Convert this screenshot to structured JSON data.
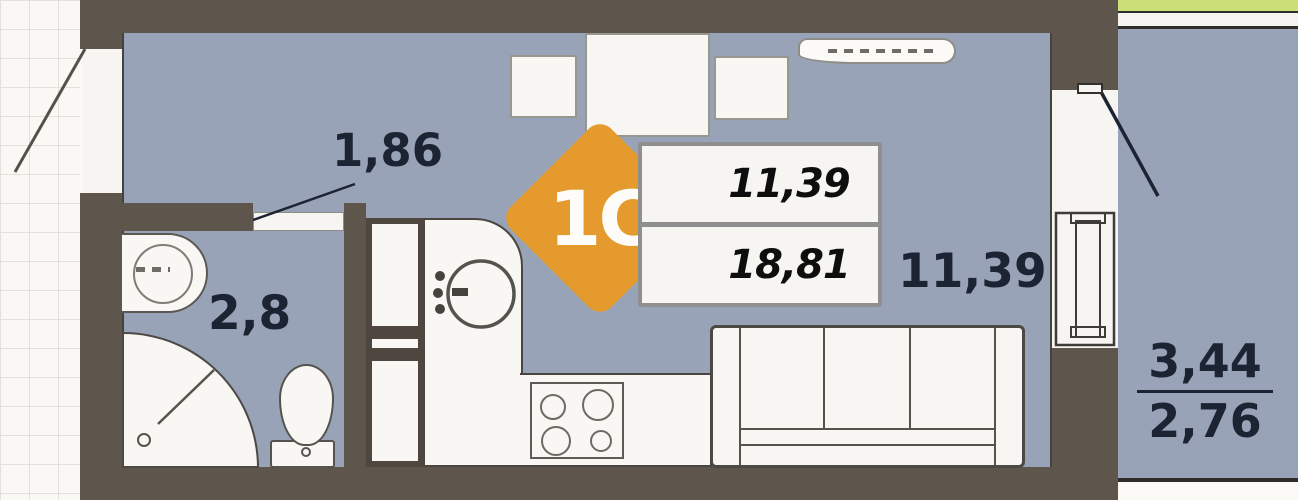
{
  "title": "Studio apartment floor plan",
  "badge": {
    "label": "1C"
  },
  "area_box": {
    "living_area": "11,39",
    "total_area": "18,81"
  },
  "room_labels": {
    "hallway_area": "1,86",
    "bathroom_area": "2,8",
    "main_room_area": "11,39",
    "balcony_area_full": "3,44",
    "balcony_area_reduced": "2,76"
  },
  "colors": {
    "floor": "#99a3b7",
    "wall": "#5e554c",
    "badge": "#e49a2d",
    "green": "#ccde77",
    "label": "#1c2333",
    "outline": "#4a463f",
    "box-border": "#8f8f8f"
  },
  "fixtures": [
    "dining-table",
    "chair",
    "cooker-hood-shelf",
    "wardrobe-column",
    "kitchen-counter",
    "kitchen-sink",
    "cooktop-4-burner",
    "sofa",
    "bathroom-sink",
    "shower-cabin",
    "toilet"
  ]
}
